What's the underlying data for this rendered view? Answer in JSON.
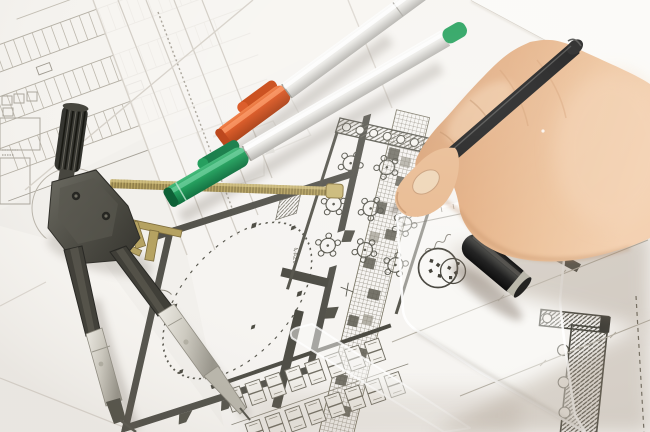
{
  "scene": {
    "type": "photograph",
    "description": "A right hand drawing with a black fineliner pen on overlapping architectural blueprint sheets; a drafting compass with spread legs lies at left, capped orange and green marker pens lie diagonally across the plans, a black pen cap and a transparent set-square ruler with a circular logo stamp sit at lower right.",
    "objects": [
      "site-plan-sheet",
      "floor-plan-sheet",
      "blank-sheet",
      "drafting-compass",
      "brass-threaded-rod",
      "orange-marker-pen",
      "green-marker-pen",
      "black-fineliner-pen",
      "black-pen-cap",
      "transparent-set-square",
      "ruler-logo-stamp",
      "hand"
    ]
  },
  "plan_labels": {
    "room": "4-A21",
    "dimension": "3752"
  },
  "colors": {
    "paper": "#f4f2ee",
    "paper_bright": "#fbfaf7",
    "plan_dark_wall": "#4e4d44",
    "plan_faint_line": "#b7b2a8",
    "hatch": "#8a8578",
    "orange_cap": "#d9521c",
    "green_cap": "#1d9b58",
    "pen_body_silver": "#e8e7e3",
    "brass": "#b5a261",
    "black_pen": "#141414",
    "skin_light": "#f2cdab",
    "skin_mid": "#e0aa7f",
    "skin_shadow": "#b97f58",
    "cast_shadow": "#8d7c68"
  }
}
